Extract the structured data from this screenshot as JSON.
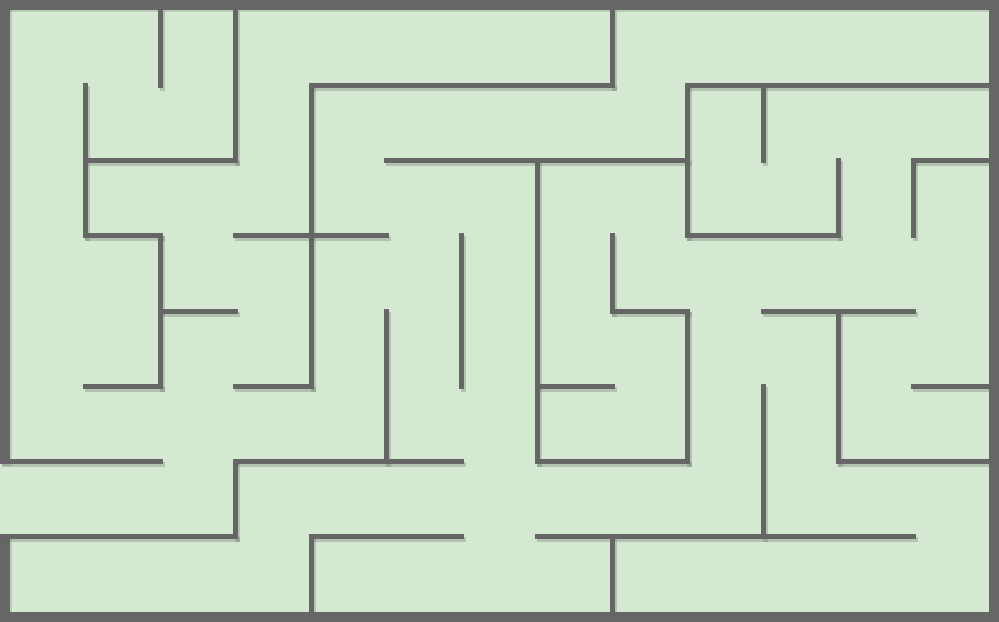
{
  "page": {
    "kind": "maze-puzzle",
    "canvas": {
      "width": 999,
      "height": 622
    }
  },
  "colors": {
    "background": "#d5e9d2",
    "wall": "#666666",
    "wall_shadow": "rgba(90,100,90,0.28)"
  },
  "maze": {
    "grid": {
      "cols": 13,
      "rows": 8,
      "origin_x": 10,
      "origin_y": 10,
      "cell_w": 75.3077,
      "cell_h": 75.25
    },
    "border_thickness": 10,
    "wall_thickness": 5,
    "entrance": {
      "side": "left",
      "row": 6
    },
    "border_segments": [
      {
        "x": 0,
        "y": 0,
        "w": 999,
        "h": 10
      },
      {
        "x": 0,
        "y": 612,
        "w": 999,
        "h": 10
      },
      {
        "x": 989,
        "y": 0,
        "w": 10,
        "h": 622
      },
      {
        "x": 0,
        "y": 0,
        "w": 10,
        "h": 464
      },
      {
        "x": 0,
        "y": 534,
        "w": 10,
        "h": 88
      }
    ],
    "walls_v": [
      {
        "c": 1,
        "r1": 1,
        "r2": 3
      },
      {
        "c": 2,
        "r1": 0,
        "r2": 1
      },
      {
        "c": 2,
        "r1": 3,
        "r2": 5
      },
      {
        "c": 3,
        "r1": 0,
        "r2": 2
      },
      {
        "c": 3,
        "r1": 6,
        "r2": 7
      },
      {
        "c": 4,
        "r1": 1,
        "r2": 5
      },
      {
        "c": 4,
        "r1": 7,
        "r2": 8
      },
      {
        "c": 5,
        "r1": 4,
        "r2": 6
      },
      {
        "c": 6,
        "r1": 3,
        "r2": 5
      },
      {
        "c": 7,
        "r1": 2,
        "r2": 6
      },
      {
        "c": 8,
        "r1": 0,
        "r2": 1
      },
      {
        "c": 8,
        "r1": 3,
        "r2": 4
      },
      {
        "c": 8,
        "r1": 7,
        "r2": 8
      },
      {
        "c": 9,
        "r1": 1,
        "r2": 3
      },
      {
        "c": 9,
        "r1": 4,
        "r2": 6
      },
      {
        "c": 10,
        "r1": 1,
        "r2": 2
      },
      {
        "c": 10,
        "r1": 5,
        "r2": 7
      },
      {
        "c": 11,
        "r1": 2,
        "r2": 3
      },
      {
        "c": 11,
        "r1": 4,
        "r2": 6
      },
      {
        "c": 12,
        "r1": 2,
        "r2": 3
      }
    ],
    "walls_h": [
      {
        "r": 1,
        "c1": 4,
        "c2": 8
      },
      {
        "r": 1,
        "c1": 9,
        "c2": 13
      },
      {
        "r": 2,
        "c1": 1,
        "c2": 3
      },
      {
        "r": 2,
        "c1": 5,
        "c2": 9
      },
      {
        "r": 2,
        "c1": 12,
        "c2": 13
      },
      {
        "r": 3,
        "c1": 1,
        "c2": 2
      },
      {
        "r": 3,
        "c1": 3,
        "c2": 5
      },
      {
        "r": 3,
        "c1": 9,
        "c2": 11
      },
      {
        "r": 4,
        "c1": 2,
        "c2": 3
      },
      {
        "r": 4,
        "c1": 8,
        "c2": 9
      },
      {
        "r": 4,
        "c1": 10,
        "c2": 12
      },
      {
        "r": 5,
        "c1": 1,
        "c2": 2
      },
      {
        "r": 5,
        "c1": 3,
        "c2": 4
      },
      {
        "r": 5,
        "c1": 7,
        "c2": 8
      },
      {
        "r": 5,
        "c1": 12,
        "c2": 13
      },
      {
        "r": 6,
        "c1": 0,
        "c2": 2,
        "ext_left": true
      },
      {
        "r": 6,
        "c1": 3,
        "c2": 6
      },
      {
        "r": 6,
        "c1": 7,
        "c2": 9
      },
      {
        "r": 6,
        "c1": 11,
        "c2": 13
      },
      {
        "r": 7,
        "c1": 0,
        "c2": 3,
        "ext_left": true
      },
      {
        "r": 7,
        "c1": 4,
        "c2": 6
      },
      {
        "r": 7,
        "c1": 7,
        "c2": 12
      }
    ]
  }
}
